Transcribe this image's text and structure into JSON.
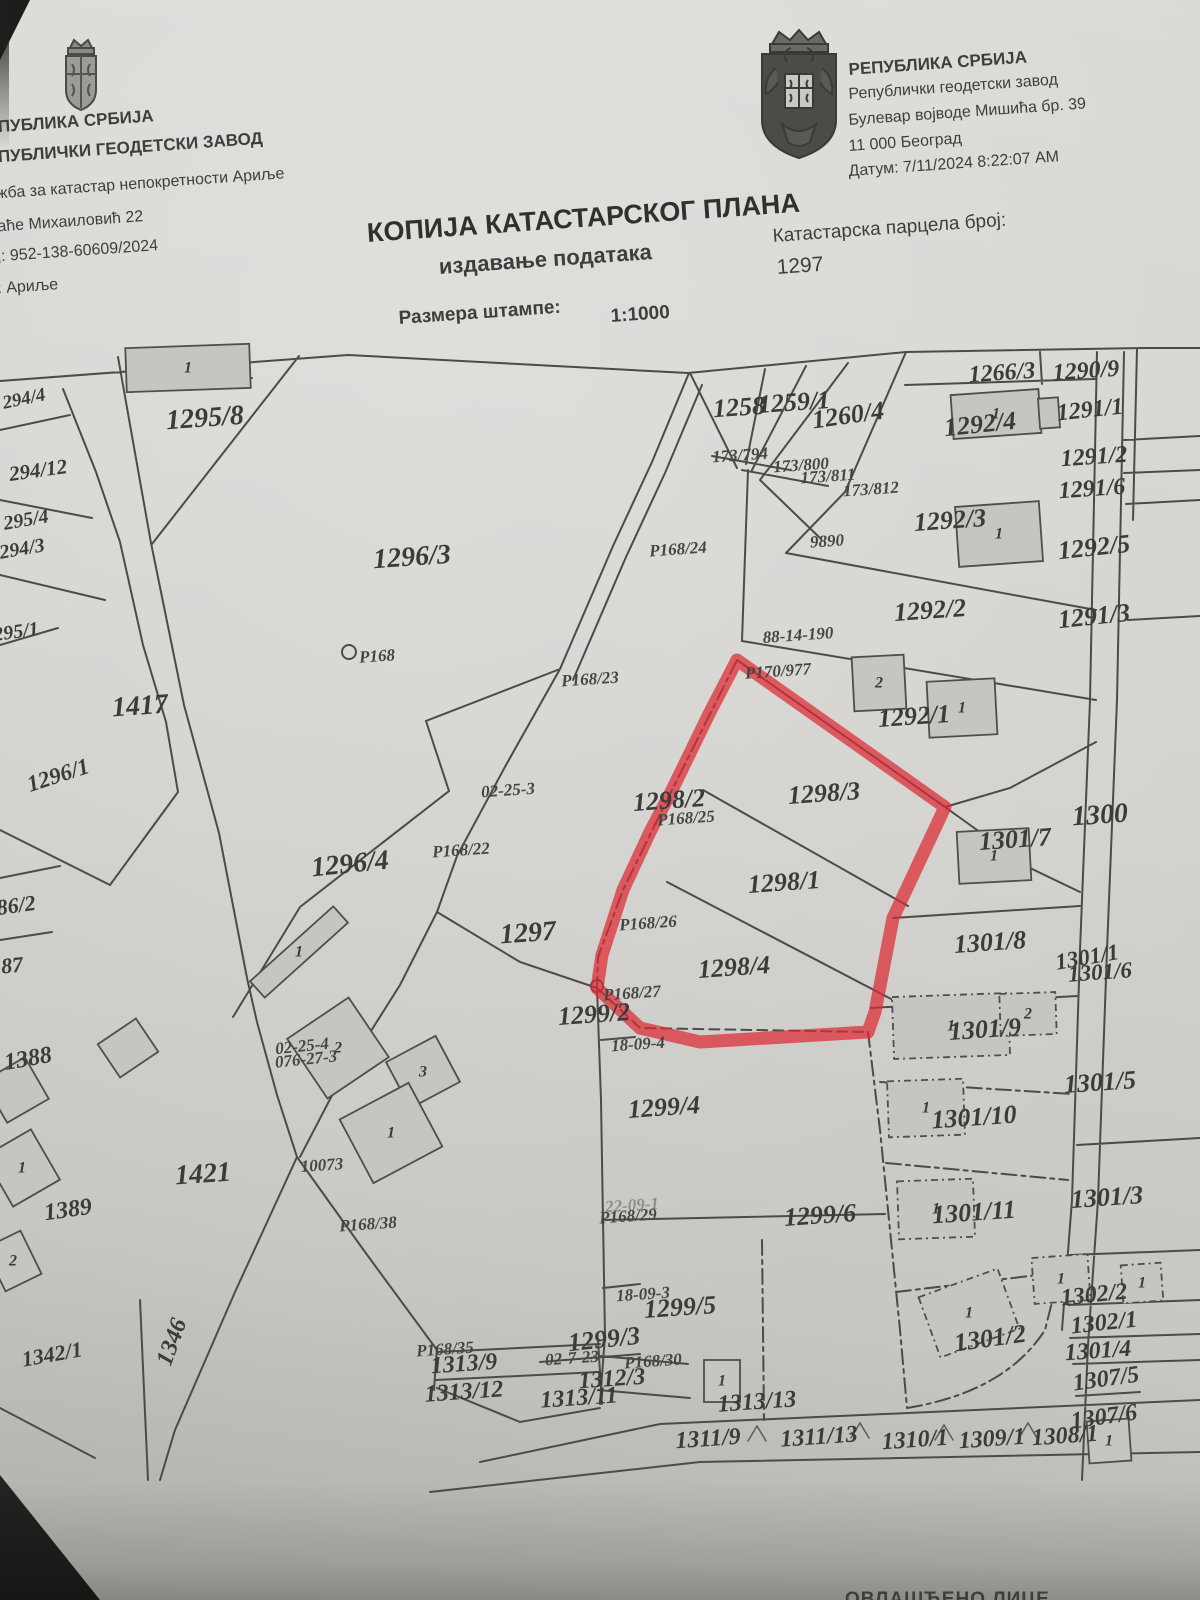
{
  "header": {
    "left": {
      "line1": "ЕПУБЛИКА СРБИЈА",
      "line2": "ЕПУБЛИЧКИ ГЕОДЕТСКИ ЗАВОД",
      "line3": "ужба за катастар непокретности Ариље",
      "line4": "раће Михаиловић 22",
      "line5": "ој: 952-138-60609/2024",
      "line6": "р: Ариље"
    },
    "right": {
      "line1": "РЕПУБЛИКА СРБИЈА",
      "line2": "Републички геодетски завод",
      "line3": "Булевар војводе Мишића бр. 39",
      "line4": "11 000 Београд",
      "line5": "Датум: 7/11/2024 8:22:07 AM"
    },
    "title": "КОПИЈА КАТАСТАРСКОГ ПЛАНА",
    "subtitle": "издавање података",
    "parcel_caption": "Катастарска парцела број:",
    "parcel_number": "1297",
    "scale_caption": "Размера штампе:",
    "scale_value": "1:1000"
  },
  "footer": {
    "fragment": "ОВЛАШЋЕНО ЛИЦЕ"
  },
  "map": {
    "highlight_color": "#dc2a33",
    "highlighted_parcels": [
      "1298/2",
      "1298/3",
      "1298/1",
      "1298/4"
    ],
    "labels": [
      {
        "t": "1295/8",
        "x": 205,
        "y": 418,
        "s": 28,
        "r": -4,
        "c": "p"
      },
      {
        "t": "294/4",
        "x": 24,
        "y": 399,
        "s": 19,
        "r": -12,
        "c": "p"
      },
      {
        "t": "294/12",
        "x": 38,
        "y": 470,
        "s": 21,
        "r": -8,
        "c": "p"
      },
      {
        "t": "295/4",
        "x": 26,
        "y": 520,
        "s": 20,
        "r": -10,
        "c": "p"
      },
      {
        "t": "294/3",
        "x": 22,
        "y": 549,
        "s": 20,
        "r": -10,
        "c": "p"
      },
      {
        "t": "295/1",
        "x": 16,
        "y": 632,
        "s": 20,
        "r": -8,
        "c": "p"
      },
      {
        "t": "1296/3",
        "x": 412,
        "y": 557,
        "s": 28,
        "r": -4,
        "c": "p"
      },
      {
        "t": "1417",
        "x": 140,
        "y": 706,
        "s": 28,
        "r": -4,
        "c": "p"
      },
      {
        "t": "1296/1",
        "x": 58,
        "y": 775,
        "s": 23,
        "r": -18,
        "c": "p"
      },
      {
        "t": "86/2",
        "x": 16,
        "y": 905,
        "s": 22,
        "r": -8,
        "c": "p"
      },
      {
        "t": "87",
        "x": 12,
        "y": 965,
        "s": 22,
        "r": -6,
        "c": "p"
      },
      {
        "t": "1296/4",
        "x": 350,
        "y": 864,
        "s": 28,
        "r": -6,
        "c": "p"
      },
      {
        "t": "1297",
        "x": 528,
        "y": 933,
        "s": 28,
        "r": -4,
        "c": "p"
      },
      {
        "t": "1388",
        "x": 28,
        "y": 1059,
        "s": 24,
        "r": -10,
        "c": "p"
      },
      {
        "t": "1421",
        "x": 203,
        "y": 1174,
        "s": 28,
        "r": -4,
        "c": "p"
      },
      {
        "t": "1389",
        "x": 68,
        "y": 1210,
        "s": 24,
        "r": -8,
        "c": "p"
      },
      {
        "t": "1342/1",
        "x": 52,
        "y": 1354,
        "s": 22,
        "r": -10,
        "c": "p"
      },
      {
        "t": "1346",
        "x": 172,
        "y": 1342,
        "s": 24,
        "r": -70,
        "c": "p"
      },
      {
        "t": "1258",
        "x": 739,
        "y": 407,
        "s": 26,
        "r": -4,
        "c": "p"
      },
      {
        "t": "1259/1",
        "x": 794,
        "y": 402,
        "s": 26,
        "r": -4,
        "c": "p"
      },
      {
        "t": "1260/4",
        "x": 848,
        "y": 415,
        "s": 26,
        "r": -8,
        "c": "p"
      },
      {
        "t": "1266/3",
        "x": 1002,
        "y": 373,
        "s": 24,
        "r": -4,
        "c": "p"
      },
      {
        "t": "1290/9",
        "x": 1086,
        "y": 371,
        "s": 24,
        "r": -4,
        "c": "p"
      },
      {
        "t": "1292/4",
        "x": 980,
        "y": 424,
        "s": 26,
        "r": -6,
        "c": "p"
      },
      {
        "t": "1291/1",
        "x": 1090,
        "y": 410,
        "s": 24,
        "r": -6,
        "c": "p"
      },
      {
        "t": "1291/2",
        "x": 1094,
        "y": 457,
        "s": 24,
        "r": -4,
        "c": "p"
      },
      {
        "t": "1291/6",
        "x": 1092,
        "y": 489,
        "s": 24,
        "r": -4,
        "c": "p"
      },
      {
        "t": "1292/3",
        "x": 950,
        "y": 520,
        "s": 26,
        "r": -4,
        "c": "p"
      },
      {
        "t": "1292/5",
        "x": 1094,
        "y": 547,
        "s": 26,
        "r": -6,
        "c": "p"
      },
      {
        "t": "1292/2",
        "x": 930,
        "y": 610,
        "s": 26,
        "r": -4,
        "c": "p"
      },
      {
        "t": "1291/3",
        "x": 1094,
        "y": 616,
        "s": 26,
        "r": -6,
        "c": "p"
      },
      {
        "t": "1292/1",
        "x": 914,
        "y": 716,
        "s": 26,
        "r": -4,
        "c": "p"
      },
      {
        "t": "1300",
        "x": 1100,
        "y": 815,
        "s": 28,
        "r": -4,
        "c": "p"
      },
      {
        "t": "1301/7",
        "x": 1015,
        "y": 839,
        "s": 26,
        "r": -4,
        "c": "p"
      },
      {
        "t": "1298/2",
        "x": 669,
        "y": 800,
        "s": 26,
        "r": -4,
        "c": "p"
      },
      {
        "t": "1298/3",
        "x": 824,
        "y": 793,
        "s": 26,
        "r": -4,
        "c": "p"
      },
      {
        "t": "1298/1",
        "x": 784,
        "y": 882,
        "s": 26,
        "r": -4,
        "c": "p"
      },
      {
        "t": "1298/4",
        "x": 734,
        "y": 967,
        "s": 26,
        "r": -4,
        "c": "p"
      },
      {
        "t": "1301/8",
        "x": 990,
        "y": 942,
        "s": 26,
        "r": -4,
        "c": "p"
      },
      {
        "t": "1301/1",
        "x": 1087,
        "y": 957,
        "s": 23,
        "r": -10,
        "c": "p"
      },
      {
        "t": "1301/6",
        "x": 1100,
        "y": 972,
        "s": 23,
        "r": -4,
        "c": "p"
      },
      {
        "t": "1299/2",
        "x": 594,
        "y": 1014,
        "s": 26,
        "r": -4,
        "c": "p"
      },
      {
        "t": "1301/9",
        "x": 985,
        "y": 1029,
        "s": 26,
        "r": -4,
        "c": "p"
      },
      {
        "t": "1301/5",
        "x": 1100,
        "y": 1082,
        "s": 26,
        "r": -4,
        "c": "p"
      },
      {
        "t": "1299/4",
        "x": 664,
        "y": 1107,
        "s": 26,
        "r": -4,
        "c": "p"
      },
      {
        "t": "1301/10",
        "x": 974,
        "y": 1117,
        "s": 26,
        "r": -4,
        "c": "p"
      },
      {
        "t": "1301/3",
        "x": 1107,
        "y": 1197,
        "s": 26,
        "r": -4,
        "c": "p"
      },
      {
        "t": "1299/6",
        "x": 820,
        "y": 1215,
        "s": 26,
        "r": -4,
        "c": "p"
      },
      {
        "t": "1301/11",
        "x": 974,
        "y": 1212,
        "s": 26,
        "r": -4,
        "c": "p"
      },
      {
        "t": "1299/5",
        "x": 680,
        "y": 1307,
        "s": 26,
        "r": -4,
        "c": "p"
      },
      {
        "t": "1302/2",
        "x": 1094,
        "y": 1295,
        "s": 24,
        "r": -6,
        "c": "p"
      },
      {
        "t": "1302/1",
        "x": 1104,
        "y": 1323,
        "s": 24,
        "r": -6,
        "c": "p"
      },
      {
        "t": "1301/2",
        "x": 990,
        "y": 1338,
        "s": 26,
        "r": -8,
        "c": "p"
      },
      {
        "t": "1301/4",
        "x": 1098,
        "y": 1351,
        "s": 24,
        "r": -4,
        "c": "p"
      },
      {
        "t": "1307/5",
        "x": 1106,
        "y": 1379,
        "s": 24,
        "r": -8,
        "c": "p"
      },
      {
        "t": "1299/3",
        "x": 604,
        "y": 1339,
        "s": 26,
        "r": -6,
        "c": "p"
      },
      {
        "t": "1313/9",
        "x": 464,
        "y": 1364,
        "s": 24,
        "r": -4,
        "c": "p"
      },
      {
        "t": "1313/12",
        "x": 464,
        "y": 1392,
        "s": 24,
        "r": -4,
        "c": "p"
      },
      {
        "t": "1312/3",
        "x": 612,
        "y": 1379,
        "s": 24,
        "r": -4,
        "c": "p"
      },
      {
        "t": "1313/11",
        "x": 579,
        "y": 1398,
        "s": 24,
        "r": -4,
        "c": "p"
      },
      {
        "t": "1313/13",
        "x": 757,
        "y": 1402,
        "s": 24,
        "r": -4,
        "c": "p"
      },
      {
        "t": "1311/9",
        "x": 708,
        "y": 1439,
        "s": 24,
        "r": -4,
        "c": "p"
      },
      {
        "t": "1311/13",
        "x": 819,
        "y": 1437,
        "s": 24,
        "r": -4,
        "c": "p"
      },
      {
        "t": "1310/1",
        "x": 915,
        "y": 1440,
        "s": 24,
        "r": -4,
        "c": "p"
      },
      {
        "t": "1309/1",
        "x": 992,
        "y": 1439,
        "s": 24,
        "r": -4,
        "c": "p"
      },
      {
        "t": "1308/1",
        "x": 1065,
        "y": 1436,
        "s": 24,
        "r": -4,
        "c": "p"
      },
      {
        "t": "1307/6",
        "x": 1104,
        "y": 1417,
        "s": 24,
        "r": -8,
        "c": "p"
      },
      {
        "t": "P168",
        "x": 377,
        "y": 656,
        "r": -4,
        "c": "s"
      },
      {
        "t": "P168/23",
        "x": 590,
        "y": 679,
        "r": -4,
        "c": "s"
      },
      {
        "t": "P168/24",
        "x": 678,
        "y": 549,
        "r": -4,
        "c": "s"
      },
      {
        "t": "P168/22",
        "x": 461,
        "y": 850,
        "r": -4,
        "c": "s"
      },
      {
        "t": "P168/25",
        "x": 686,
        "y": 818,
        "r": -4,
        "c": "s"
      },
      {
        "t": "P168/26",
        "x": 648,
        "y": 923,
        "r": -4,
        "c": "s"
      },
      {
        "t": "P168/27",
        "x": 632,
        "y": 993,
        "r": -4,
        "c": "s"
      },
      {
        "t": "P168/38",
        "x": 368,
        "y": 1224,
        "r": -4,
        "c": "s"
      },
      {
        "t": "22-09-1",
        "x": 632,
        "y": 1205,
        "r": -4,
        "c": "s f"
      },
      {
        "t": "P168/29",
        "x": 628,
        "y": 1216,
        "r": -4,
        "c": "s"
      },
      {
        "t": "P168/30",
        "x": 653,
        "y": 1361,
        "r": -4,
        "c": "s"
      },
      {
        "t": "P168/35",
        "x": 445,
        "y": 1349,
        "r": -4,
        "c": "s"
      },
      {
        "t": "P170/977",
        "x": 778,
        "y": 671,
        "r": -4,
        "c": "s"
      },
      {
        "t": "88-14-190",
        "x": 798,
        "y": 635,
        "r": -4,
        "c": "s"
      },
      {
        "t": "02-25-3",
        "x": 508,
        "y": 790,
        "r": -4,
        "c": "s"
      },
      {
        "t": "02-25-4",
        "x": 302,
        "y": 1046,
        "r": -6,
        "c": "s"
      },
      {
        "t": "076-27-3",
        "x": 306,
        "y": 1059,
        "r": -6,
        "c": "s"
      },
      {
        "t": "18-09-4",
        "x": 638,
        "y": 1044,
        "r": -4,
        "c": "s"
      },
      {
        "t": "18-09-3",
        "x": 643,
        "y": 1294,
        "r": -4,
        "c": "s"
      },
      {
        "t": "10073",
        "x": 322,
        "y": 1165,
        "r": -4,
        "c": "s"
      },
      {
        "t": "9890",
        "x": 827,
        "y": 541,
        "r": -4,
        "c": "s"
      },
      {
        "t": "02-7-23",
        "x": 572,
        "y": 1358,
        "r": -4,
        "c": "s"
      },
      {
        "t": "173/794",
        "x": 740,
        "y": 455,
        "s": 15,
        "r": -4,
        "c": "s"
      },
      {
        "t": "173/800",
        "x": 801,
        "y": 465,
        "s": 15,
        "r": -4,
        "c": "s"
      },
      {
        "t": "173/811",
        "x": 828,
        "y": 476,
        "s": 15,
        "r": -4,
        "c": "s"
      },
      {
        "t": "173/812",
        "x": 871,
        "y": 489,
        "s": 15,
        "r": -4,
        "c": "s"
      }
    ],
    "buildings": [
      {
        "x": 188,
        "y": 368,
        "w": 124,
        "h": 44,
        "r": -2,
        "t": "1"
      },
      {
        "x": 996,
        "y": 414,
        "w": 88,
        "h": 44,
        "r": -4,
        "t": "1"
      },
      {
        "x": 1049,
        "y": 413,
        "w": 20,
        "h": 30,
        "r": -4,
        "t": ""
      },
      {
        "x": 999,
        "y": 534,
        "w": 84,
        "h": 60,
        "r": -4,
        "t": "1"
      },
      {
        "x": 879,
        "y": 683,
        "w": 52,
        "h": 54,
        "r": -3,
        "t": "2"
      },
      {
        "x": 962,
        "y": 708,
        "w": 68,
        "h": 56,
        "r": -3,
        "t": "1"
      },
      {
        "x": 994,
        "y": 856,
        "w": 72,
        "h": 52,
        "r": -3,
        "t": "1"
      },
      {
        "x": 951,
        "y": 1026,
        "w": 116,
        "h": 62,
        "r": -2,
        "t": "1",
        "d": true
      },
      {
        "x": 1028,
        "y": 1014,
        "w": 56,
        "h": 42,
        "r": -2,
        "t": "2",
        "d": true
      },
      {
        "x": 926,
        "y": 1108,
        "w": 76,
        "h": 56,
        "r": -2,
        "t": "1",
        "d": true
      },
      {
        "x": 936,
        "y": 1209,
        "w": 76,
        "h": 58,
        "r": -2,
        "t": "1",
        "d": true
      },
      {
        "x": 969,
        "y": 1313,
        "w": 84,
        "h": 64,
        "r": -20,
        "t": "1",
        "d": true
      },
      {
        "x": 1061,
        "y": 1279,
        "w": 56,
        "h": 46,
        "r": -4,
        "t": "1",
        "d": true
      },
      {
        "x": 1142,
        "y": 1283,
        "w": 40,
        "h": 38,
        "r": -4,
        "t": "1",
        "d": true
      },
      {
        "x": 1109,
        "y": 1441,
        "w": 42,
        "h": 42,
        "r": -4,
        "t": "1"
      },
      {
        "x": 722,
        "y": 1381,
        "w": 36,
        "h": 42,
        "r": 0,
        "t": "1"
      },
      {
        "x": 338,
        "y": 1048,
        "w": 74,
        "h": 72,
        "r": -34,
        "t": "2"
      },
      {
        "x": 423,
        "y": 1072,
        "w": 56,
        "h": 52,
        "r": -28,
        "t": "3"
      },
      {
        "x": 391,
        "y": 1133,
        "w": 78,
        "h": 72,
        "r": -28,
        "t": "1"
      },
      {
        "x": 299,
        "y": 952,
        "w": 112,
        "h": 22,
        "r": -42,
        "t": "1"
      },
      {
        "x": 22,
        "y": 1168,
        "w": 54,
        "h": 58,
        "r": -30,
        "t": "1"
      },
      {
        "x": 13,
        "y": 1261,
        "w": 40,
        "h": 48,
        "r": -26,
        "t": "2"
      },
      {
        "x": 16,
        "y": 1090,
        "w": 48,
        "h": 48,
        "r": -30,
        "t": ""
      },
      {
        "x": 128,
        "y": 1048,
        "w": 46,
        "h": 40,
        "r": -34,
        "t": ""
      }
    ]
  }
}
